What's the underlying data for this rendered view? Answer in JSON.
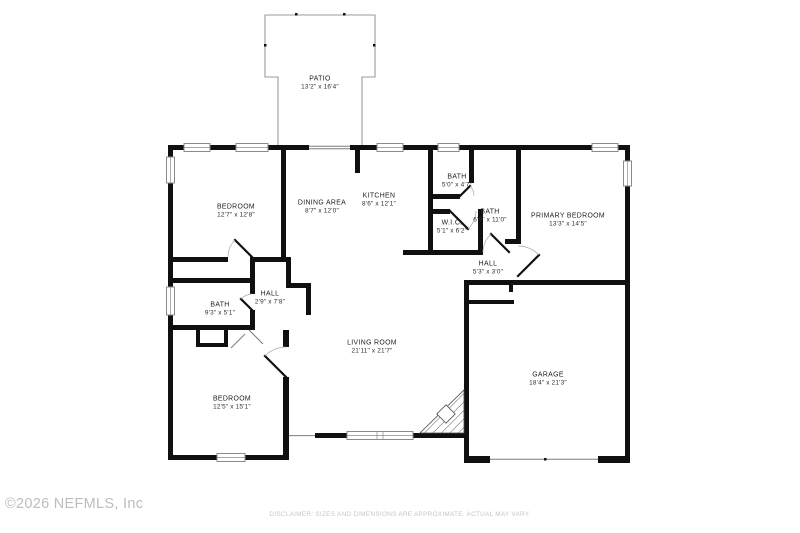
{
  "footer": {
    "copyright": "©2026 NEFMLS, Inc",
    "disclaimer": "DISCLAIMER: SIZES AND DIMENSIONS ARE APPROXIMATE. ACTUAL MAY VARY."
  },
  "floorplan": {
    "colors": {
      "wall": "#101010",
      "window_stroke": "#8a8a8a",
      "patio_stroke": "#9b9b9b",
      "label_text": "#1e1e1e",
      "watermark_text": "#bdbdbd"
    },
    "rooms": [
      {
        "id": "patio",
        "name": "PATIO",
        "dims": "13'2\" x 16'4\"",
        "x": 320,
        "y": 83
      },
      {
        "id": "bedroom-1",
        "name": "BEDROOM",
        "dims": "12'7\" x 12'8\"",
        "x": 236,
        "y": 211
      },
      {
        "id": "dining-area",
        "name": "DINING AREA",
        "dims": "8'7\" x 12'0\"",
        "x": 322,
        "y": 207
      },
      {
        "id": "kitchen",
        "name": "KITCHEN",
        "dims": "8'6\" x 12'1\"",
        "x": 379,
        "y": 200
      },
      {
        "id": "bath-top",
        "name": "BATH",
        "dims": "5'0\" x 4'7\"",
        "x": 457,
        "y": 181
      },
      {
        "id": "bath-primary",
        "name": "BATH",
        "dims": "6'9\" x 11'0\"",
        "x": 490,
        "y": 216
      },
      {
        "id": "wic",
        "name": "W.I.C.",
        "dims": "5'1\" x 6'2\"",
        "x": 452,
        "y": 227
      },
      {
        "id": "primary-bedroom",
        "name": "PRIMARY BEDROOM",
        "dims": "13'3\" x 14'5\"",
        "x": 568,
        "y": 220
      },
      {
        "id": "hall-primary",
        "name": "HALL",
        "dims": "5'3\" x 3'0\"",
        "x": 488,
        "y": 268
      },
      {
        "id": "hall-bedrooms",
        "name": "HALL",
        "dims": "2'9\" x 7'8\"",
        "x": 270,
        "y": 298
      },
      {
        "id": "bath-left",
        "name": "BATH",
        "dims": "9'3\" x 5'1\"",
        "x": 220,
        "y": 309
      },
      {
        "id": "living-room",
        "name": "LIVING ROOM",
        "dims": "21'11\" x 21'7\"",
        "x": 372,
        "y": 347
      },
      {
        "id": "bedroom-2",
        "name": "BEDROOM",
        "dims": "12'5\" x 15'1\"",
        "x": 232,
        "y": 403
      },
      {
        "id": "garage",
        "name": "GARAGE",
        "dims": "18'4\" x 21'3\"",
        "x": 548,
        "y": 379
      }
    ]
  }
}
